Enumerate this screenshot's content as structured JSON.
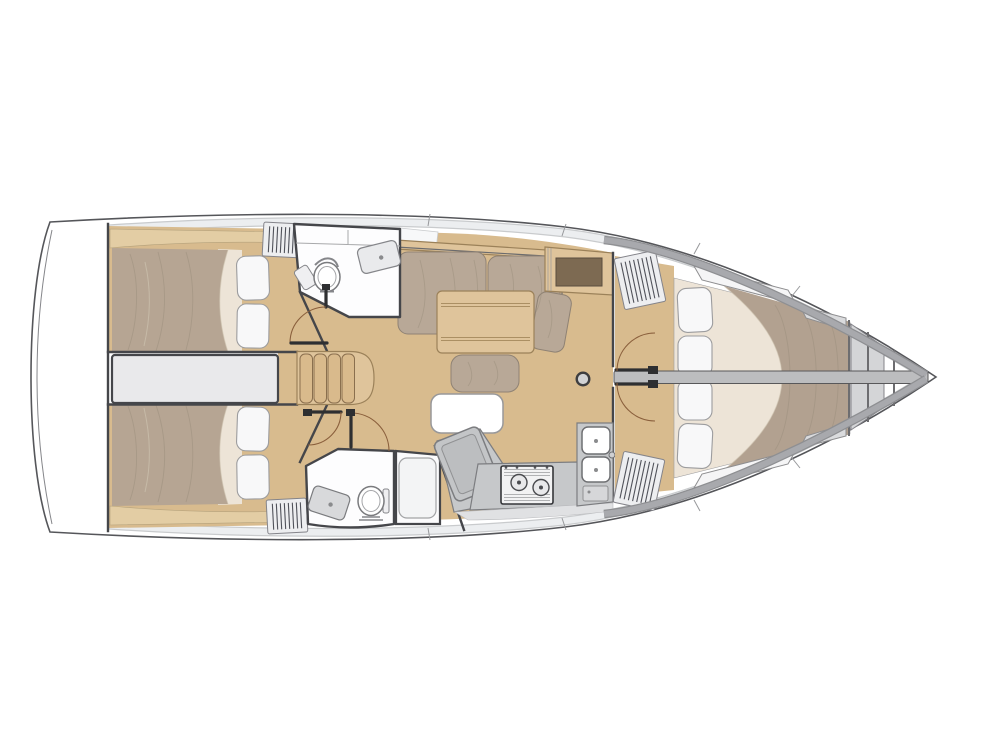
{
  "diagram": {
    "type": "sailboat-interior-floor-plan",
    "view": "top-down",
    "bow_direction": "right",
    "stern_direction": "left"
  },
  "features": {
    "aft_cabins": 2,
    "forward_cabins": 1,
    "heads": 2,
    "showers": 1,
    "companionway_steps": 4,
    "stove_burners": 2,
    "galley_sink_basins": 2,
    "head_sinks": 2,
    "toilets": 2,
    "forward_berth_pillows": 4,
    "aft_berth_pillows": 4,
    "hanging_lockers": 4,
    "salon_tables": 1,
    "mast_posts": 1
  },
  "colors": {
    "hull-line": "#55565a",
    "deck-band": "#eceef0",
    "deck-edge": "#c9cbcd",
    "bow-band": "#a8a9ad",
    "bow-band-edge": "#8e8f92",
    "wall": "#45464a",
    "wood-floor": "#d8bb8e",
    "wood-shelf": "#e3cda4",
    "wood-furniture": "#dfc49b",
    "wood-line": "#9b8159",
    "tread": "#d9ba8c",
    "mattress": "#b6a593",
    "blanket": "#b2a190",
    "sheet": "#ede4d7",
    "cushion": "#b8a897",
    "cushion-line": "#8f8274",
    "pillow": "#f8f8f9",
    "pillow-line": "#9c9c9e",
    "counter": "#c6c8ca",
    "counter-line": "#7c7d80",
    "module": "#c3c5c7",
    "engine": "#e9e9eb",
    "locker": "#edeef0",
    "louver": "#50525a",
    "fixture-line": "#7a7b7e",
    "dark-inset": "#7d6a52",
    "door-arc": "#8a5f3c",
    "leaf": "#2e2f31",
    "center-band": "#bcbdbf",
    "post": "#d2d3d5",
    "tray-line": "#a2a3a5",
    "panel-gray": "#d6d7d9",
    "bench": "#f5f5f6",
    "bench-dark": "#dadbdd",
    "shadow-line": "#97989b",
    "wrinkle": "#9a8d7c",
    "head-floor": "#fdfdfe"
  }
}
